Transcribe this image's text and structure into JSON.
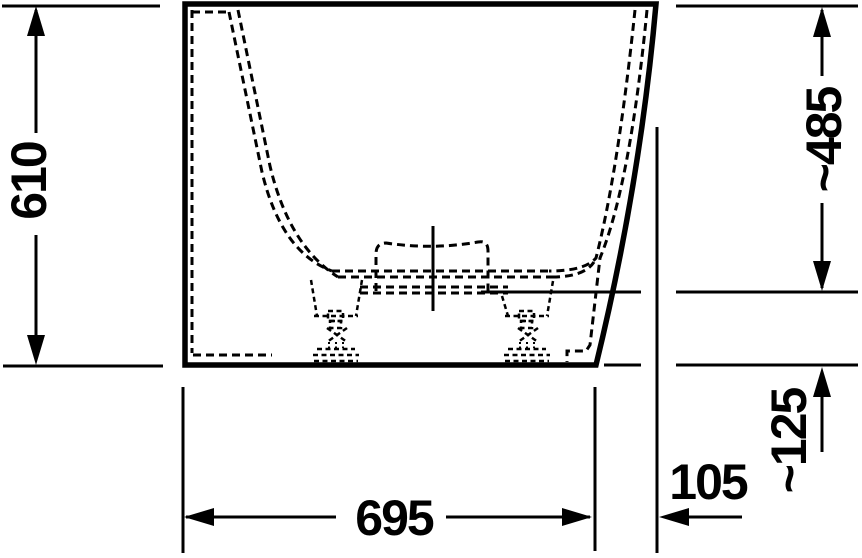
{
  "drawing": {
    "title": "bathtub-side-elevation-technical-drawing",
    "background": "#ffffff",
    "line_color": "#000000",
    "units_shown": "none (bare numbers, mm implied by drawing style)",
    "dimensions": {
      "overall_height": {
        "label": "610",
        "orientation": "vertical-left"
      },
      "rim_to_waterline_height": {
        "label": "~485",
        "orientation": "vertical-right"
      },
      "waterline_to_floor_height": {
        "label": "~125",
        "orientation": "vertical-right-lower"
      },
      "base_width": {
        "label": "695",
        "orientation": "horizontal-bottom"
      },
      "top_overhang_width": {
        "label": "105",
        "orientation": "horizontal-bottom-right"
      }
    },
    "parts": [
      "tub-outer-shell-solid-outline",
      "tub-inner-bowl-dashed-profile",
      "center-drain-fitting-dashed-box",
      "vertical-centerline",
      "water-level-reference-line",
      "adjustable-support-foot-left",
      "adjustable-support-foot-right",
      "floor-reference-line"
    ]
  }
}
